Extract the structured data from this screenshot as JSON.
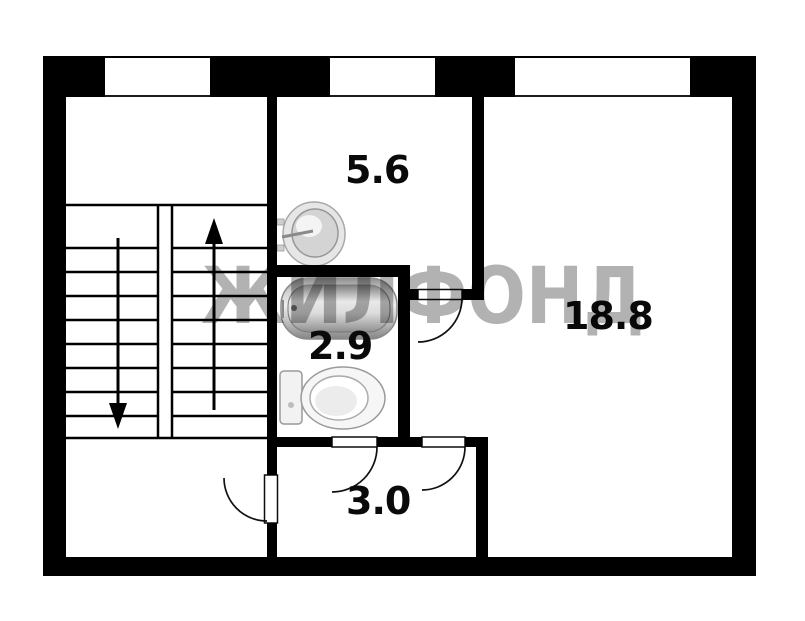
{
  "plan": {
    "type": "apartment-floor-plan",
    "watermark": {
      "text": "ЖИЛФОНД",
      "color": "#b2b2b2"
    },
    "rooms": [
      {
        "name": "kitchen",
        "area": "5.6"
      },
      {
        "name": "living-room",
        "area": "18.8"
      },
      {
        "name": "bathroom",
        "area": "2.9"
      },
      {
        "name": "hallway",
        "area": "3.0"
      }
    ],
    "fixtures": [
      "sink",
      "bathtub",
      "toilet"
    ],
    "stairs": {
      "flights": 2,
      "arrows": [
        "down",
        "up"
      ]
    },
    "doors": 4,
    "windows": 3,
    "colors": {
      "walls": "#000000",
      "background": "#ffffff",
      "fixture_fill": "#e8e8e8"
    }
  }
}
